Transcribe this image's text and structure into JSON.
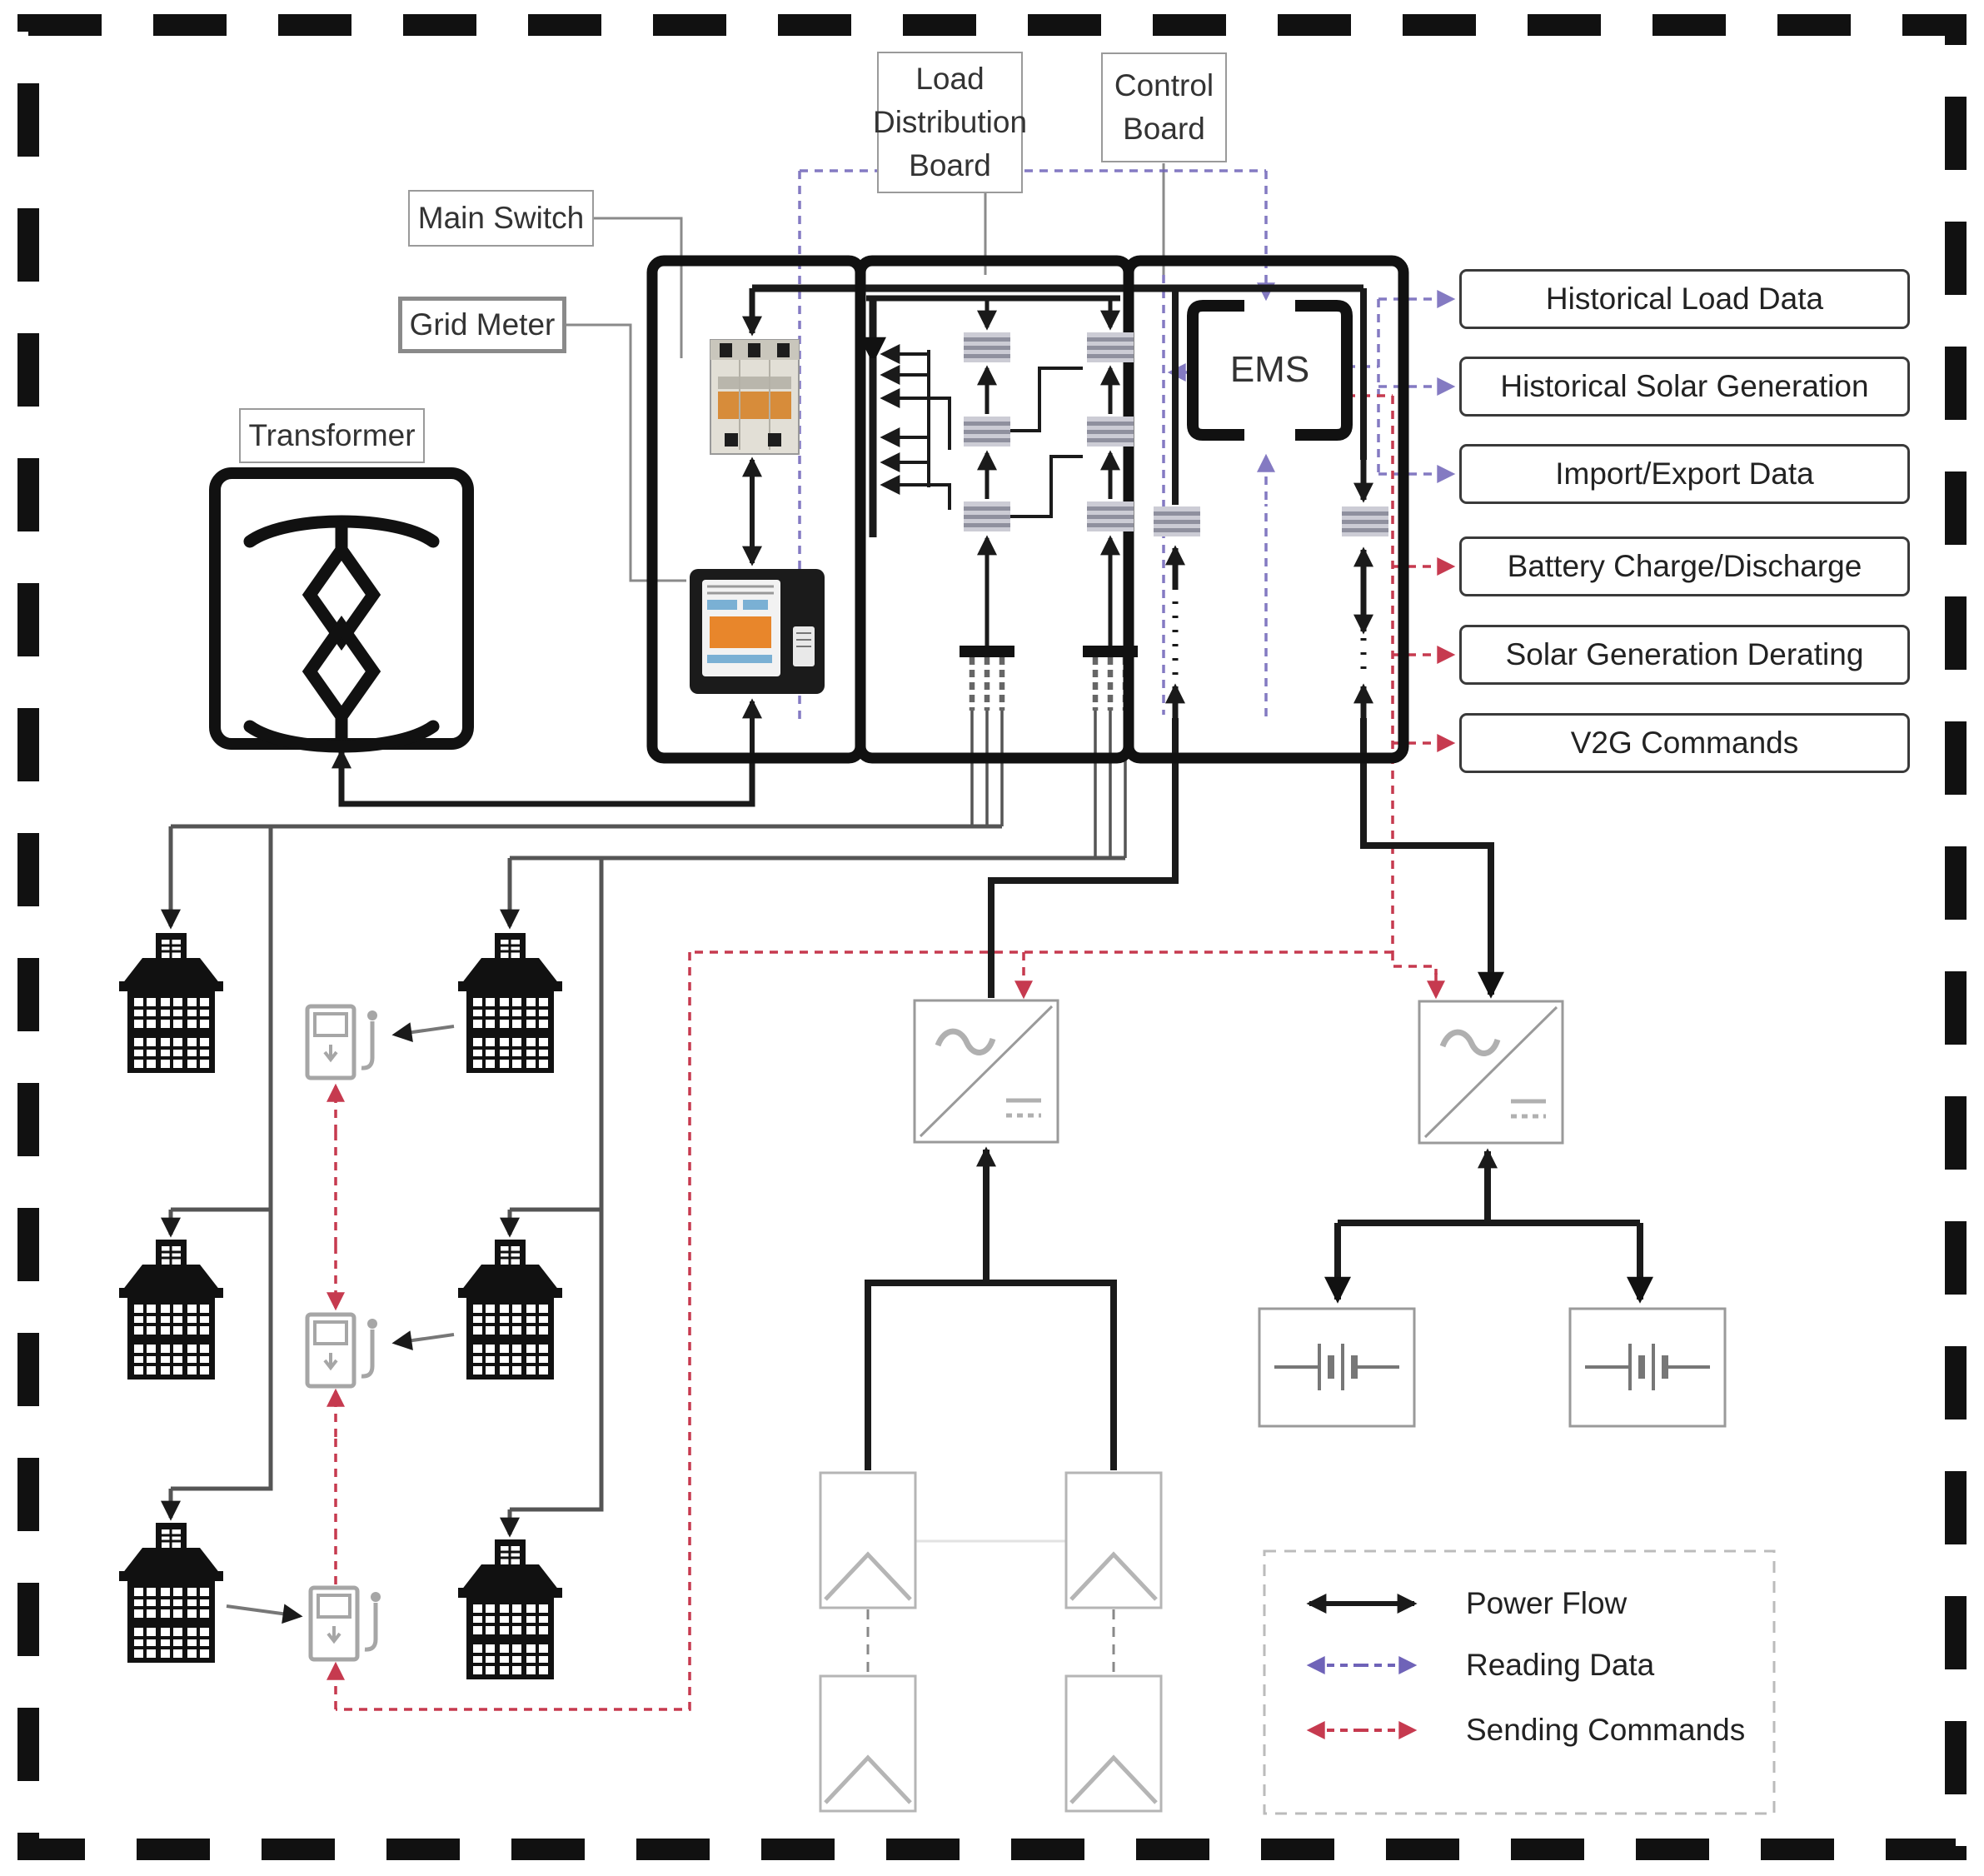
{
  "diagram": {
    "labels": {
      "load_distribution_board": "Load Distribution Board",
      "control_board": "Control Board",
      "main_switch": "Main Switch",
      "grid_meter": "Grid Meter",
      "transformer": "Transformer",
      "ems": "EMS"
    },
    "data_outputs": [
      "Historical Load Data",
      "Historical Solar Generation",
      "Import/Export Data"
    ],
    "command_outputs": [
      "Battery Charge/Discharge",
      "Solar Generation Derating",
      "V2G Commands"
    ],
    "legend": {
      "items": [
        {
          "label": "Power Flow",
          "color": "#1a1a1a"
        },
        {
          "label": "Reading Data",
          "color": "#6f63b8"
        },
        {
          "label": "Sending Commands",
          "color": "#c63a4f"
        }
      ]
    }
  }
}
